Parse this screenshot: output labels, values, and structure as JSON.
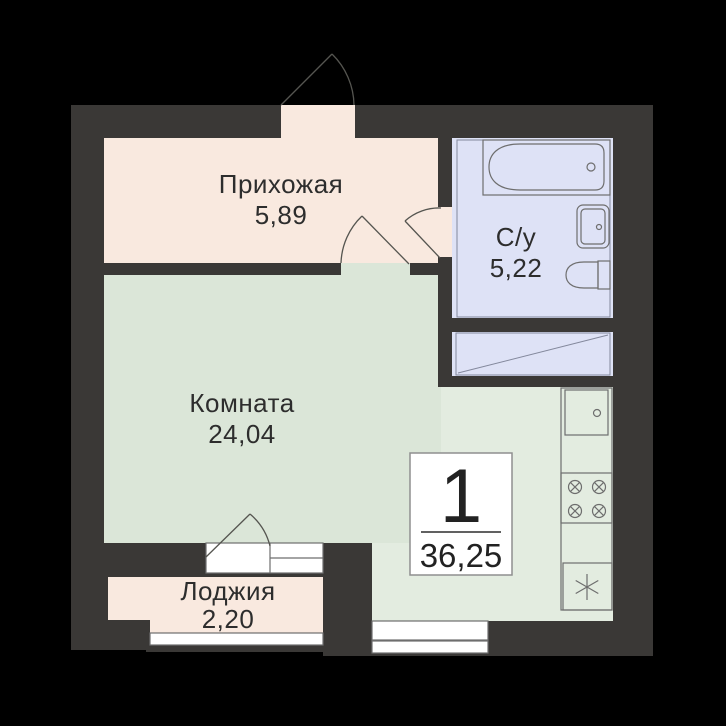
{
  "plan": {
    "rooms": [
      {
        "name": "Прихожая",
        "area": "5,89"
      },
      {
        "name": "С/у",
        "area": "5,22"
      },
      {
        "name": "Комната",
        "area": "24,04"
      },
      {
        "name": "Лоджия",
        "area": "2,20"
      }
    ],
    "info_box": {
      "apartment_number": "1",
      "total_area": "36,25"
    },
    "colors": {
      "background": "#000000",
      "wall": "#3a3836",
      "hallway_floor": "#f9e9df",
      "room_floor": "#dbe6d8",
      "kitchen_floor": "#e3ece0",
      "bathroom_floor": "#dee2f6",
      "shaft_floor": "#dee2f6",
      "loggia_floor": "#f9e9df",
      "window_fill": "#ffffff",
      "outline": "#6e6e6e",
      "door_arc": "#555550",
      "text": "#2d2d2d",
      "info_border": "#8f8f8f"
    }
  }
}
